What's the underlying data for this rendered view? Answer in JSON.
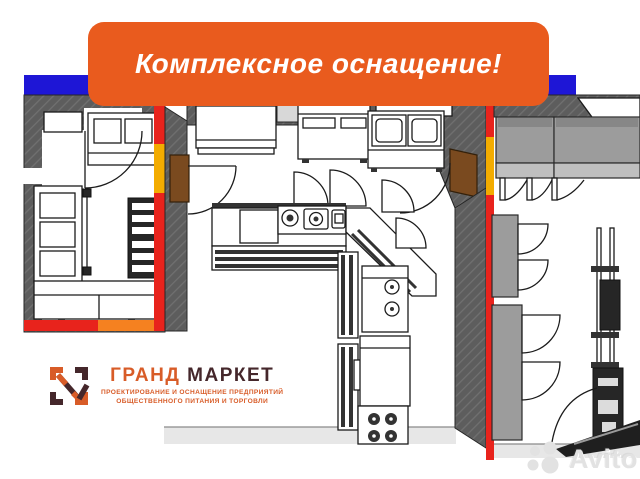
{
  "banner": {
    "text": "Комплексное оснащение!"
  },
  "logo": {
    "brand_first": "ГРАНД",
    "brand_second": "МАРКЕТ",
    "tagline_line1": "ПРОЕКТИРОВАНИЕ И ОСНАЩЕНИЕ ПРЕДПРИЯТИЙ",
    "tagline_line2": "ОБЩЕСТВЕННОГО ПИТАНИЯ И ТОРГОВЛИ"
  },
  "watermark": {
    "text": "Avito"
  },
  "icons": {
    "grand_market_logo_icon": "corner-brackets-with-checkmark",
    "avito_logo_icon": "four-circles"
  },
  "colors": {
    "banner_orange": "#E95B1E",
    "accent_blue": "#1E16D6",
    "wall_red": "#E8231C",
    "wall_yellow": "#F3AC00",
    "wall_orange": "#F58120",
    "wall_gray": "#5D5D5D",
    "equipment_gray": "#9C9C9C",
    "floor_gray": "#E7E7E7",
    "door_brown": "#7A4A1F",
    "logo_orange": "#D85C28",
    "logo_dark": "#45272B",
    "watermark_gray": "#E2E2E2"
  }
}
